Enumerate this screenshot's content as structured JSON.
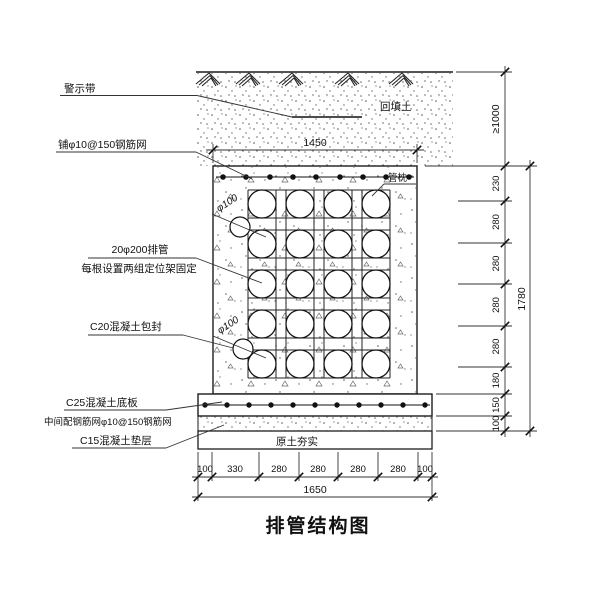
{
  "drawing": {
    "title": "排管结构图",
    "labels": {
      "warning_tape": "警示带",
      "top_mesh": "铺φ10@150钢筋网",
      "pipes_line1": "20φ200排管",
      "pipes_line2": "每根设置两组定位架固定",
      "encasement": "C20混凝土包封",
      "base_slab": "C25混凝土底板",
      "slab_mesh": "中间配钢筋网φ10@150钢筋网",
      "cushion": "C15混凝土垫层",
      "backfill": "回填土",
      "pipe_pillow": "管枕",
      "drain_top": "φ100",
      "drain_bottom": "φ100",
      "compacted_soil": "原土夯实"
    },
    "dimensions": {
      "top_width": "1450",
      "min_cover": "≥1000",
      "right_chain": [
        "230",
        "280",
        "280",
        "280",
        "280",
        "180",
        "150",
        "100"
      ],
      "right_total": "1780",
      "bottom_chain": [
        "100",
        "330",
        "280",
        "280",
        "280",
        "280",
        "100"
      ],
      "bottom_total": "1650"
    },
    "pipe_grid": {
      "rows": 5,
      "columns": 4
    },
    "colors": {
      "line": "#1c1c1c",
      "background": "#ffffff"
    }
  }
}
